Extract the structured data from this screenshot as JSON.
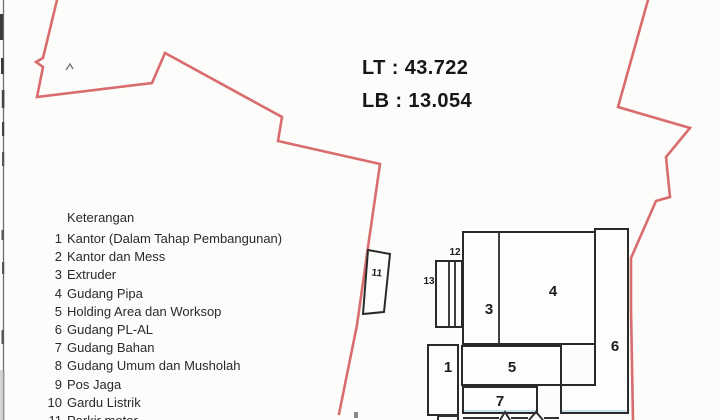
{
  "stats": {
    "lt": "LT : 43.722",
    "lb": "LB : 13.054"
  },
  "legend": {
    "title": "Keterangan",
    "items": [
      {
        "num": "1",
        "label": "Kantor (Dalam Tahap Pembangunan)"
      },
      {
        "num": "2",
        "label": "Kantor dan Mess"
      },
      {
        "num": "3",
        "label": "Extruder"
      },
      {
        "num": "4",
        "label": "Gudang Pipa"
      },
      {
        "num": "5",
        "label": "Holding Area dan Worksop"
      },
      {
        "num": "6",
        "label": "Gudang PL-AL"
      },
      {
        "num": "7",
        "label": "Gudang Bahan"
      },
      {
        "num": "8",
        "label": "Gudang Umum dan Musholah"
      },
      {
        "num": "9",
        "label": "Pos Jaga"
      },
      {
        "num": "10",
        "label": "Gardu Listrik"
      },
      {
        "num": "11",
        "label": "Parkir motor"
      }
    ]
  },
  "plan": {
    "labels": {
      "b1": "1",
      "b3": "3",
      "b4": "4",
      "b5": "5",
      "b6": "6",
      "b7": "7",
      "b11": "11",
      "b12": "12",
      "b13": "13"
    }
  },
  "colors": {
    "boundary": "#d96c6c",
    "outline": "#2a2a2a",
    "ink": "#262626"
  }
}
